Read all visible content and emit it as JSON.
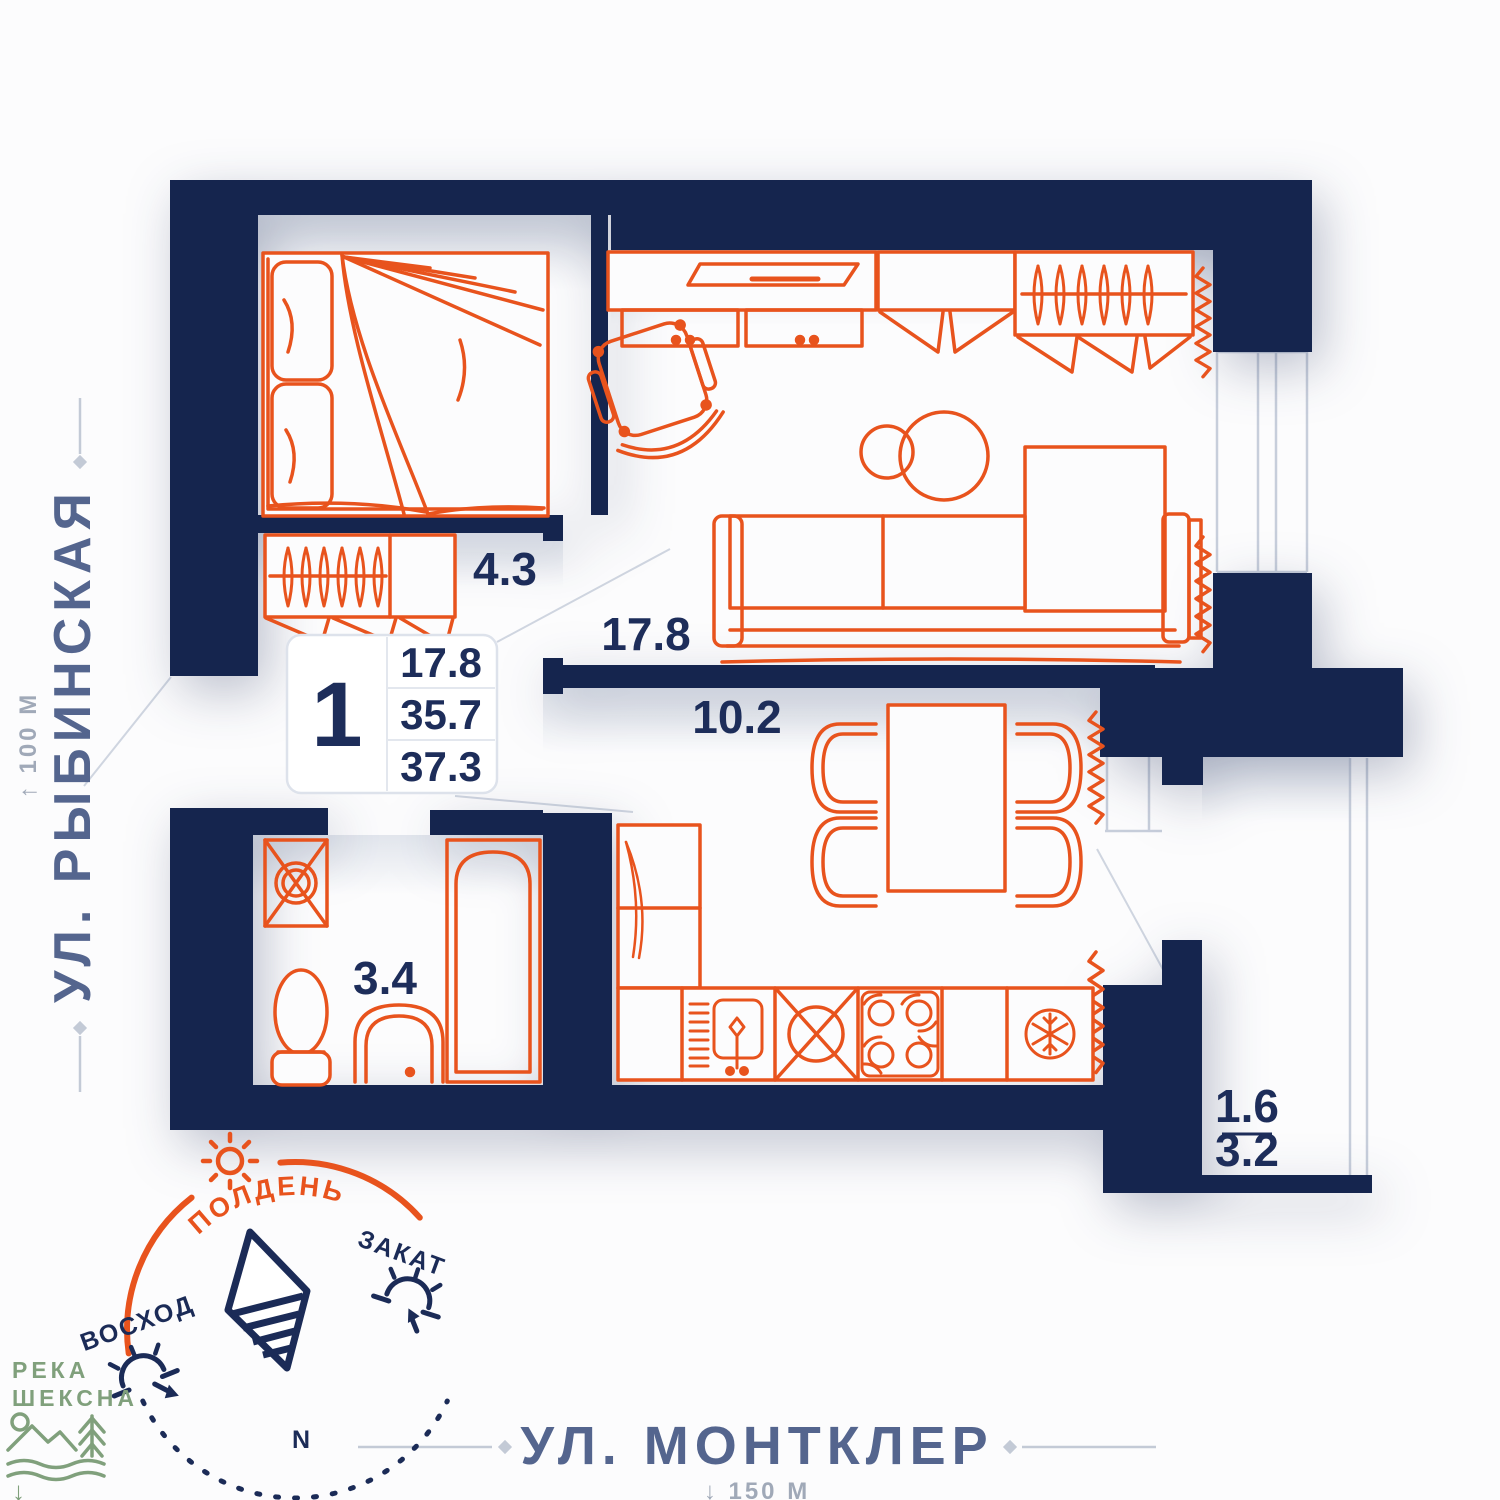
{
  "card": {
    "rooms_count": "1",
    "rows": [
      {
        "value": "17.8"
      },
      {
        "value": "35.7"
      },
      {
        "value": "37.3"
      }
    ]
  },
  "rooms": {
    "hall": "4.3",
    "living": "17.8",
    "kitchen": "10.2",
    "bathroom": "3.4",
    "balcony_reduced": "1.6",
    "balcony_full": "3.2"
  },
  "streets": {
    "left": {
      "name": "УЛ. РЫБИНСКАЯ",
      "distance": "↑ 100 М"
    },
    "bottom": {
      "name": "УЛ. МОНТКЛЕР",
      "distance": "↓ 150 М"
    }
  },
  "compass": {
    "noon": "ПОЛДЕНЬ",
    "sunrise": "ВОСХОД",
    "sunset": "ЗАКАТ",
    "north": "N"
  },
  "river": {
    "line1": "РЕКА",
    "line2": "ШЕКСНА",
    "arrow": "↓"
  },
  "colors": {
    "wall": "#15254e",
    "furniture": "#e8531d",
    "street_label": "#54658e",
    "muted": "#a0a9b8",
    "river": "#80a07c",
    "room_label": "#1d2d5a",
    "window": "#c7cedb"
  }
}
